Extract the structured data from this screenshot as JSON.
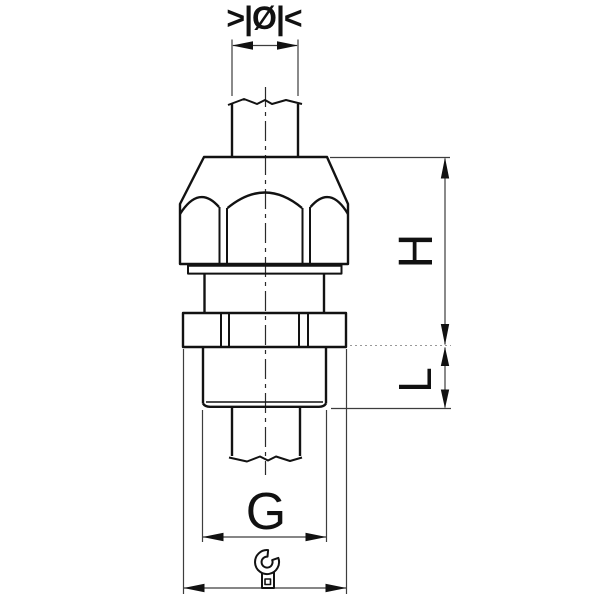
{
  "drawing": {
    "dimension_labels": {
      "cable_diameter_symbol": ">|Ø|<",
      "height": "H",
      "thread_length": "L",
      "thread_size": "G"
    },
    "icons": {
      "wrench": "wrench-icon"
    },
    "colors": {
      "background": "#ffffff",
      "outline": "#121212",
      "dimension_line": "#3d3d3d",
      "label": "#111111"
    }
  }
}
